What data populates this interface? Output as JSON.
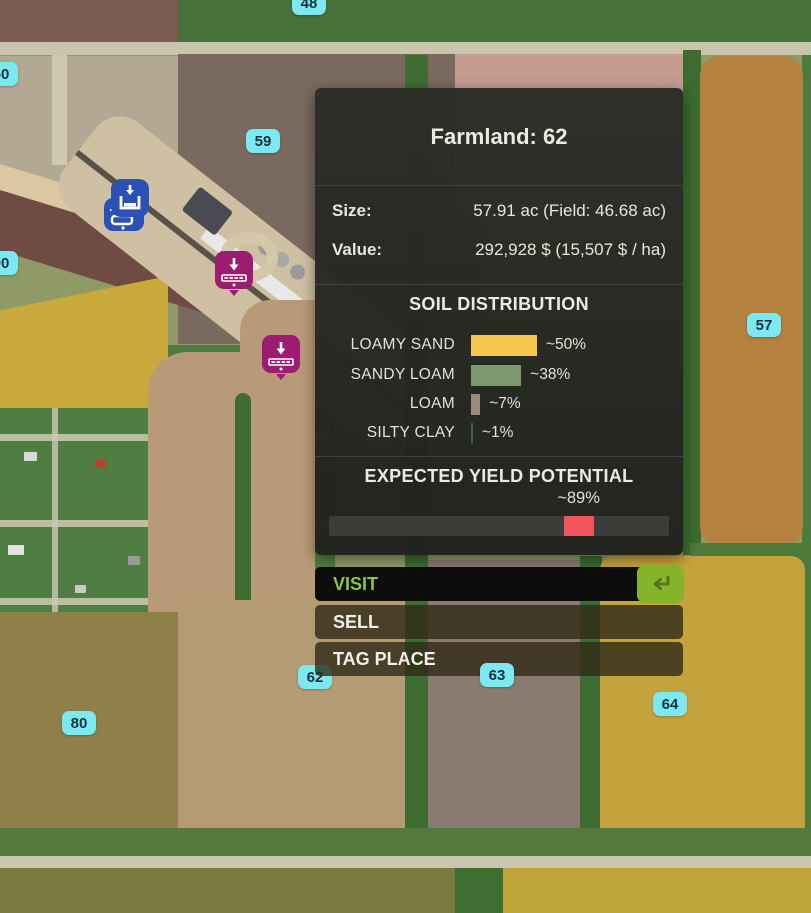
{
  "map": {
    "badges": [
      "48",
      "50",
      "59",
      "90",
      "57",
      "62",
      "63",
      "64",
      "80"
    ],
    "badge_color": "#7ce9f2",
    "icons": {
      "blue_station": "unload-container-icon",
      "purple_station_1": "sell-point-grate-icon",
      "purple_station_2": "sell-point-grate-icon"
    },
    "colors": {
      "field_brown": "#7a695e",
      "field_pink": "#c59b92",
      "field_orange": "#b5813f",
      "field_yellow": "#c4a33c",
      "field_gray": "#8b7a71",
      "field_tan": "#b49b74",
      "trees_green": "#3e6c32"
    }
  },
  "panel": {
    "title": "Farmland: 62",
    "rows": [
      {
        "label": "Size:",
        "value": "57.91 ac (Field: 46.68 ac)"
      },
      {
        "label": "Value:",
        "value": "292,928 $ (15,507 $ / ha)"
      }
    ],
    "soil": {
      "heading": "SOIL DISTRIBUTION",
      "bar_px_per_pct": 1.32,
      "items": [
        {
          "name": "LOAMY SAND",
          "pct_label": "~50%",
          "value": 50,
          "color": "#f6c64f"
        },
        {
          "name": "SANDY LOAM",
          "pct_label": "~38%",
          "value": 38,
          "color": "#7e9b70"
        },
        {
          "name": "LOAM",
          "pct_label": "~7%",
          "value": 7,
          "color": "#9b8b7f"
        },
        {
          "name": "SILTY CLAY",
          "pct_label": "~1%",
          "value": 1,
          "color": "#4a5761"
        }
      ]
    },
    "yield": {
      "heading": "EXPECTED YIELD POTENTIAL",
      "pct_label": "~89%",
      "value": 89,
      "marker_color": "#f4555c",
      "marker_left_pct": 69,
      "marker_width_px": 30
    },
    "actions": {
      "visit": "VISIT",
      "sell": "SELL",
      "tag": "TAG PLACE"
    }
  }
}
